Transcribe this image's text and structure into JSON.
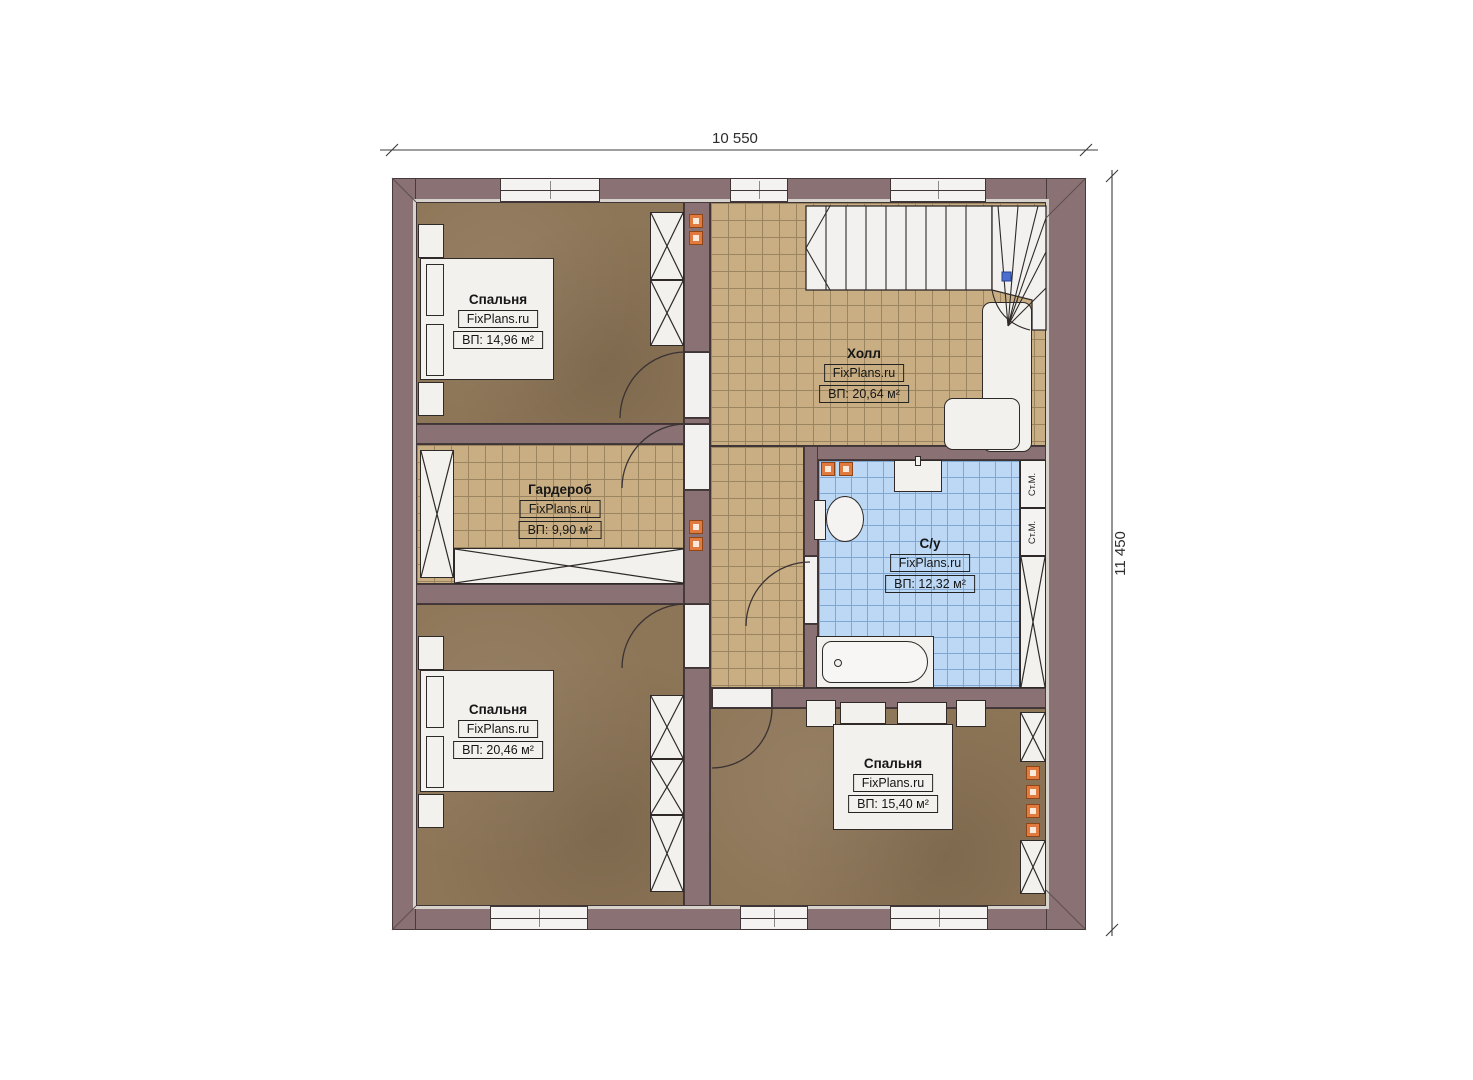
{
  "dimensions": {
    "top": "10 550",
    "right": "11 450"
  },
  "branding": {
    "watermark": "FixPlans.ru"
  },
  "rooms": {
    "bedroom_top_left": {
      "name": "Спальня",
      "area": "ВП: 14,96 м²"
    },
    "hall": {
      "name": "Холл",
      "area": "ВП: 20,64 м²"
    },
    "wardrobe": {
      "name": "Гардероб",
      "area": "ВП: 9,90 м²"
    },
    "bathroom": {
      "name": "С/у",
      "area": "ВП: 12,32 м²"
    },
    "bedroom_bottom_left": {
      "name": "Спальня",
      "area": "ВП: 20,46 м²"
    },
    "bedroom_bottom_right": {
      "name": "Спальня",
      "area": "ВП: 15,40 м²"
    }
  },
  "appliances": {
    "washing_machine": "Ст.М."
  },
  "colors": {
    "wall": "#8a7173",
    "bedroom_floor": "#8d7557",
    "tile_floor": "#c9ae84",
    "bath_floor": "#bcd8f4",
    "fixture": "#f2f1ee",
    "marker_orange": "#e07a3f",
    "stairs_marker_blue": "#4b6fd0"
  }
}
